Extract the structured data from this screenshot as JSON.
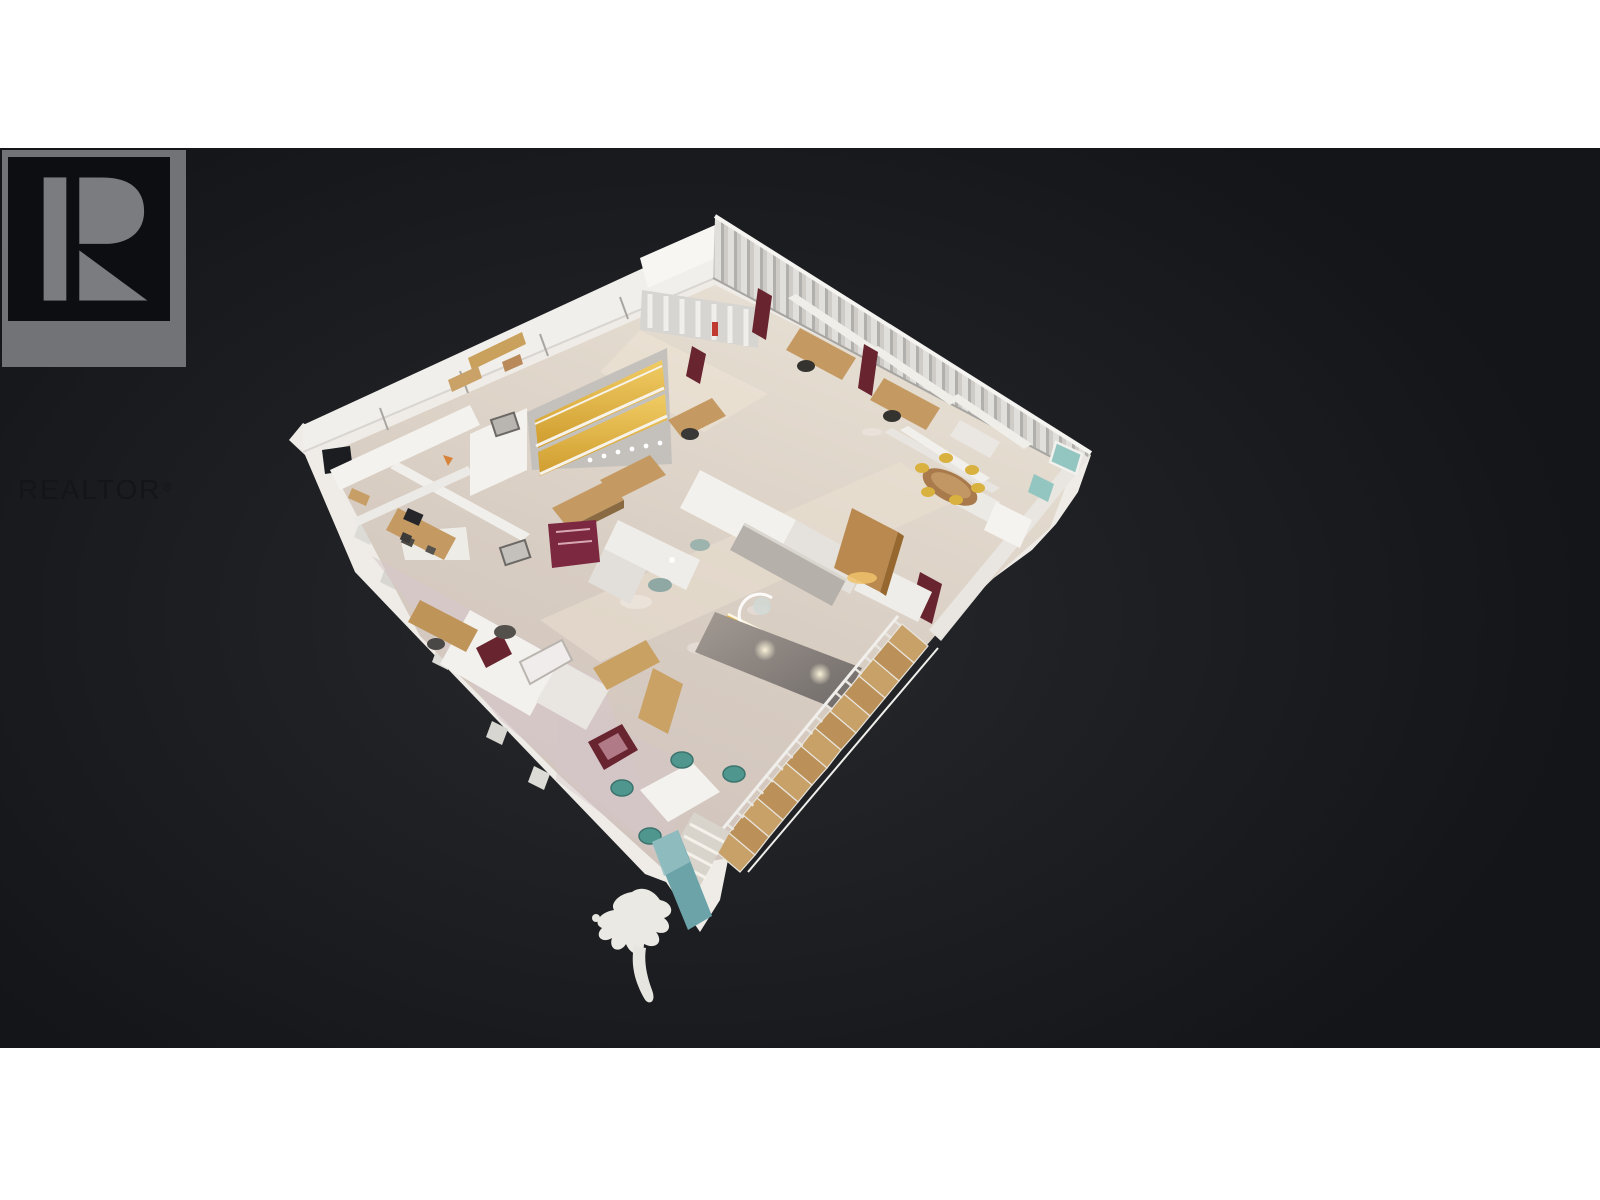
{
  "logo": {
    "text": "REALTOR",
    "registered_mark": "®"
  },
  "model": {
    "name": "dollhouse-3d-model"
  },
  "theme": {
    "page_bg": "#ffffff",
    "viewport_bg": "#1b1d21",
    "viewport_glow": "#27292d",
    "logo_badge": "#727376",
    "logo_square": "#0d0e11",
    "logo_r": "#7b7c7f",
    "logo_text": "#141518",
    "wall": "#efece7",
    "wall_shade": "#c9c5bf",
    "floor_light": "#e6ddd1",
    "floor_dark": "#cdc1b6",
    "carpet_pink": "#d5c6ca",
    "amber": "#e4b94e",
    "wood": "#c49a62",
    "maroon": "#68242f",
    "teal": "#4f968e",
    "teal_runner": "#6ba3a9",
    "glass_teal": "#93c5c1",
    "stair_wood": "#c7a168",
    "stair_wall": "#8a8280"
  }
}
